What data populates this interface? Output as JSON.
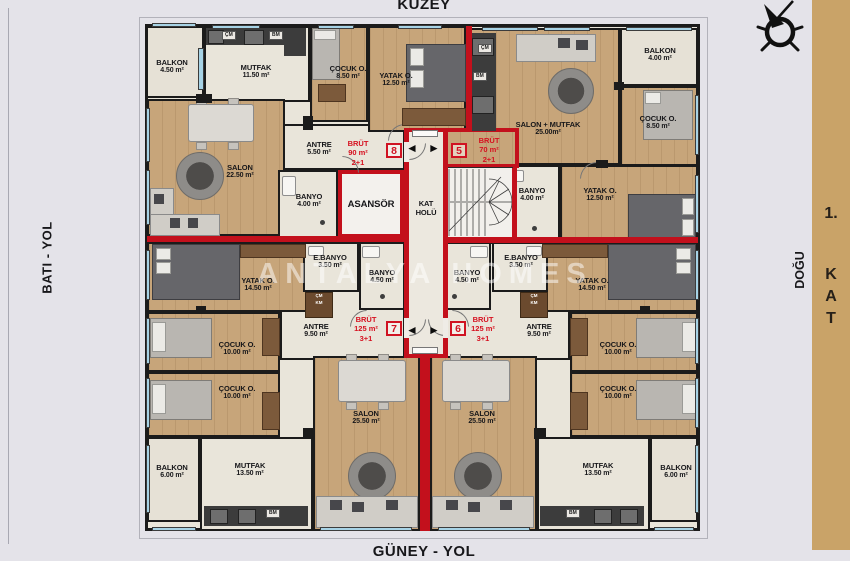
{
  "directions": {
    "north": "KUZEY",
    "south": "GÜNEY - YOL",
    "west": "BATI - YOL",
    "east": "DOĞU"
  },
  "floor_tab": {
    "num": "1.",
    "l1": "K",
    "l2": "A",
    "l3": "T"
  },
  "watermark": "ANTALYA HOMES",
  "core": {
    "elevator": "ASANSÖR",
    "hall1": "KAT",
    "hall2": "HOLÜ"
  },
  "nav_arrows": {
    "left": "◄",
    "right": "►"
  },
  "appliances": {
    "cm": "ÇM",
    "bm": "BM",
    "km": "KM"
  },
  "apartments": {
    "a8": {
      "badge": "8",
      "brut_label": "BRÜT",
      "gross_area": "90 m²",
      "layout": "2+1",
      "rooms": {
        "balkon": {
          "name": "BALKON",
          "area": "4.50 m²"
        },
        "mutfak": {
          "name": "MUTFAK",
          "area": "11.50 m²"
        },
        "cocuk": {
          "name": "ÇOCUK O.",
          "area": "8.50 m²"
        },
        "yatak": {
          "name": "YATAK O.",
          "area": "12.50 m²"
        },
        "salon": {
          "name": "SALON",
          "area": "22.50 m²"
        },
        "antre": {
          "name": "ANTRE",
          "area": "5.50 m²"
        },
        "banyo": {
          "name": "BANYO",
          "area": "4.00 m²"
        }
      }
    },
    "a5": {
      "badge": "5",
      "brut_label": "BRÜT",
      "gross_area": "70 m²",
      "layout": "2+1",
      "rooms": {
        "salon_mutfak": {
          "name": "SALON + MUTFAK",
          "area": "25.00m²"
        },
        "balkon": {
          "name": "BALKON",
          "area": "4.00 m²"
        },
        "cocuk": {
          "name": "ÇOCUK O.",
          "area": "8.50 m²"
        },
        "yatak": {
          "name": "YATAK O.",
          "area": "12.50 m²"
        },
        "banyo": {
          "name": "BANYO",
          "area": "4.00 m²"
        }
      }
    },
    "a7": {
      "badge": "7",
      "brut_label": "BRÜT",
      "gross_area": "125 m²",
      "layout": "3+1",
      "rooms": {
        "yatak": {
          "name": "YATAK O.",
          "area": "14.50 m²"
        },
        "cocuk1": {
          "name": "ÇOCUK O.",
          "area": "10.00 m²"
        },
        "cocuk2": {
          "name": "ÇOCUK O.",
          "area": "10.00 m²"
        },
        "antre": {
          "name": "ANTRE",
          "area": "9.50 m²"
        },
        "ebanyo": {
          "name": "E.BANYO",
          "area": "3.50 m²"
        },
        "banyo": {
          "name": "BANYO",
          "area": "4.50 m²"
        },
        "salon": {
          "name": "SALON",
          "area": "25.50 m²"
        },
        "mutfak": {
          "name": "MUTFAK",
          "area": "13.50 m²"
        },
        "balkon": {
          "name": "BALKON",
          "area": "6.00 m²"
        }
      }
    },
    "a6": {
      "badge": "6",
      "brut_label": "BRÜT",
      "gross_area": "125 m²",
      "layout": "3+1",
      "rooms": {
        "yatak": {
          "name": "YATAK O.",
          "area": "14.50 m²"
        },
        "cocuk1": {
          "name": "ÇOCUK O.",
          "area": "10.00 m²"
        },
        "cocuk2": {
          "name": "ÇOCUK O.",
          "area": "10.00 m²"
        },
        "antre": {
          "name": "ANTRE",
          "area": "9.50 m²"
        },
        "ebanyo": {
          "name": "E.BANYO",
          "area": "3.50 m²"
        },
        "banyo": {
          "name": "BANYO",
          "area": "4.50 m²"
        },
        "salon": {
          "name": "SALON",
          "area": "25.50 m²"
        },
        "mutfak": {
          "name": "MUTFAK",
          "area": "13.50 m²"
        },
        "balkon": {
          "name": "BALKON",
          "area": "6.00 m²"
        }
      }
    }
  }
}
